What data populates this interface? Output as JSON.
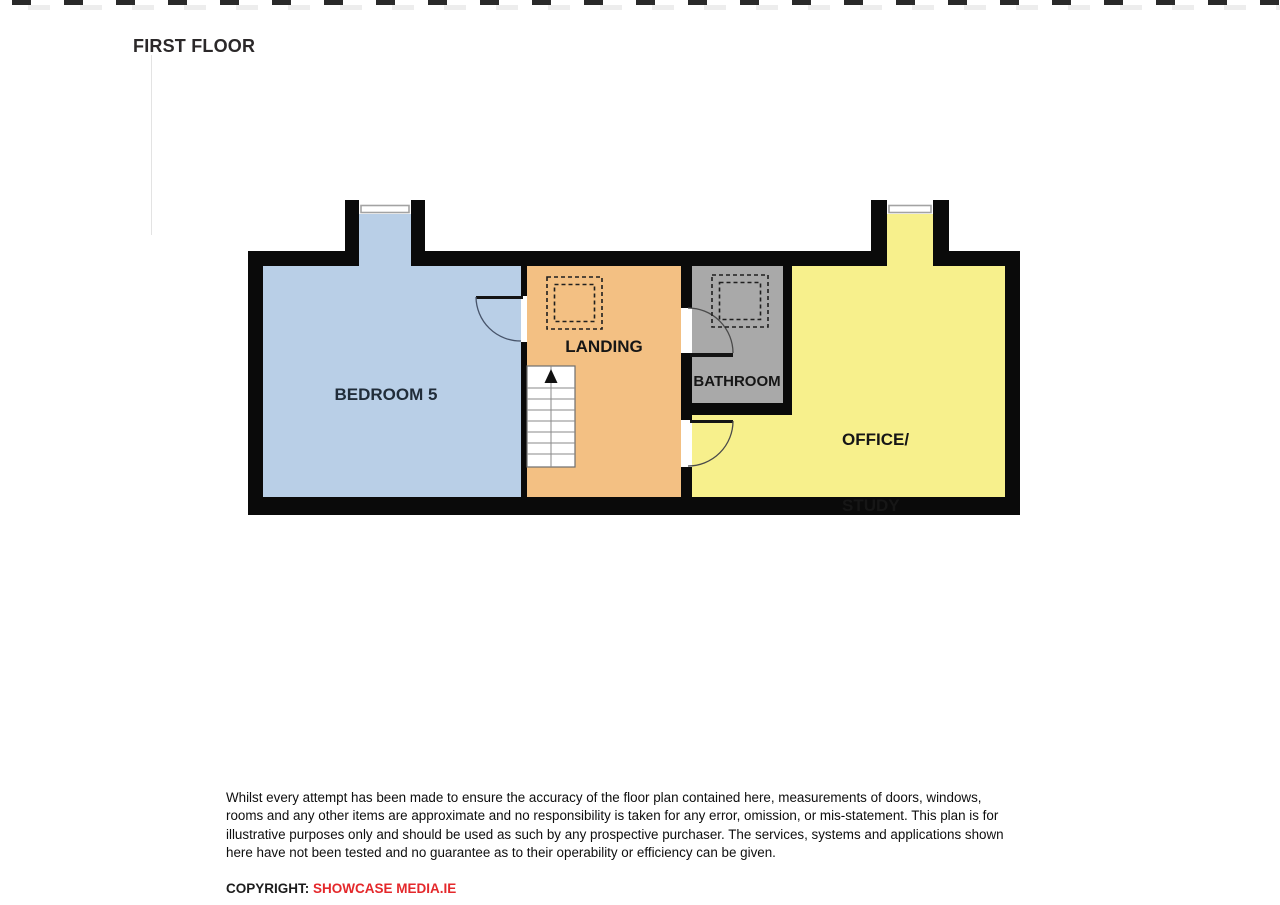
{
  "title": "FIRST FLOOR",
  "plan": {
    "wall_color": "#0a0a0a",
    "rooms": {
      "bedroom": {
        "label": "BEDROOM 5",
        "color": "#b9cfe7",
        "label_color": "#212d3a"
      },
      "landing": {
        "label": "LANDING",
        "color": "#f3c083"
      },
      "bathroom": {
        "label": "BATHROOM",
        "color": "#a9a9a9"
      },
      "office": {
        "line1": "OFFICE/",
        "line2": "STUDY",
        "color": "#f7f08c"
      }
    },
    "features": [
      "window-bedroom-dormer",
      "window-office-dormer",
      "door-bedroom",
      "door-bathroom",
      "door-office",
      "stairs-up",
      "rooflight-landing",
      "rooflight-bathroom"
    ]
  },
  "disclaimer": {
    "lines": [
      "Whilst every attempt has been made to ensure the accuracy of the floor plan contained here, measurements of doors, windows,",
      "rooms and any other items are approximate and no responsibility is taken for any error, omission, or mis-statement.  This plan is for",
      "illustrative purposes only and should be used as such by any prospective purchaser.  The services, systems and applications shown",
      "here have not been tested and no guarantee as to their operability or efficiency can be given."
    ]
  },
  "copyright": {
    "prefix": "COPYRIGHT: ",
    "brand": "SHOWCASE MEDIA.IE",
    "brand_color": "#e4282b"
  }
}
